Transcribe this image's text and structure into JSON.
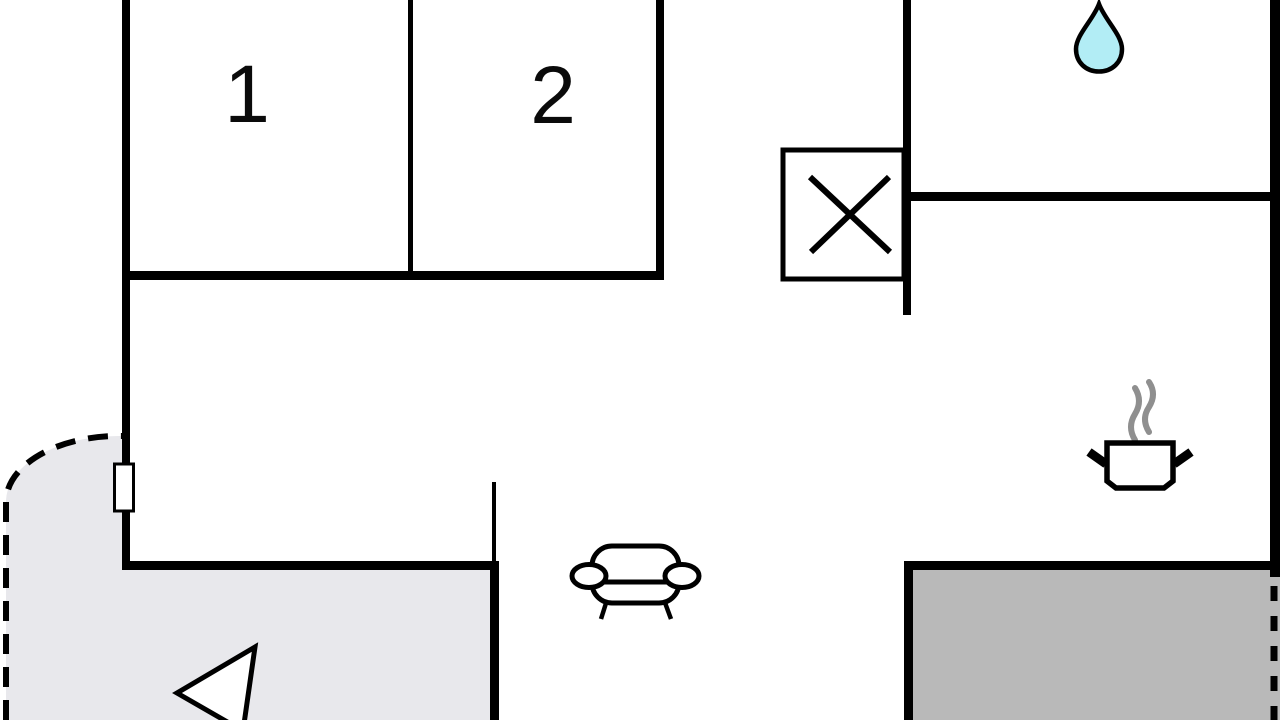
{
  "plan": {
    "type": "floor-plan",
    "rooms": [
      {
        "label": "1"
      },
      {
        "label": "2"
      }
    ],
    "icons": {
      "water_drop": "water-drop-icon",
      "shower_box": "shower-crossed-square-icon",
      "stove": "steaming-pot-icon",
      "sofa": "sofa-icon",
      "entrance_arrow": "entrance-arrow-icon",
      "window": "window-marker"
    },
    "colors": {
      "wall": "#000000",
      "terrace_fill": "#e8e8ec",
      "patio_fill": "#b9b9b9",
      "water_drop_fill": "#b2edf5",
      "steam": "#8f8f8f",
      "label": "#0a0a0a",
      "background": "#ffffff"
    }
  }
}
